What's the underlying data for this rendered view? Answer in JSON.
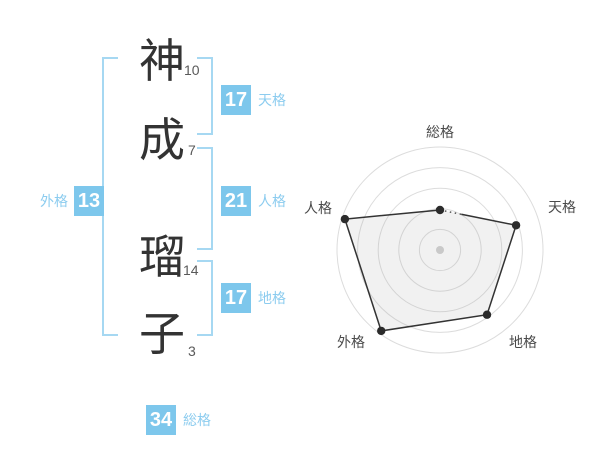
{
  "panel": {
    "name": {
      "characters": [
        {
          "char": "神",
          "strokes": 10
        },
        {
          "char": "成",
          "strokes": 7
        },
        {
          "char": "瑠",
          "strokes": 14
        },
        {
          "char": "子",
          "strokes": 3
        }
      ]
    },
    "grids": {
      "tenkaku": {
        "value": 17,
        "label": "天格"
      },
      "jinkaku": {
        "value": 21,
        "label": "人格"
      },
      "chikaku": {
        "value": 17,
        "label": "地格"
      },
      "gaikaku": {
        "value": 13,
        "label": "外格"
      },
      "soukaku": {
        "value": 34,
        "label": "総格"
      }
    }
  },
  "colors": {
    "badge_blue": "#7dc7ec",
    "bracket_blue": "#a6d8f2",
    "label_blue": "#8cccef",
    "kanji_dark": "#333333",
    "chart_line": "#333333",
    "chart_ring": "#dcdcdc",
    "chart_fill": "rgba(170,170,170,0.16)"
  },
  "chart_data": {
    "type": "radar",
    "axes": [
      "総格",
      "天格",
      "地格",
      "外格",
      "人格"
    ],
    "series": [
      {
        "name": "score",
        "values": [
          2,
          4,
          4,
          5,
          5
        ]
      }
    ],
    "max": 5,
    "rings": 5,
    "grid": "concentric-circles",
    "legend": false
  }
}
